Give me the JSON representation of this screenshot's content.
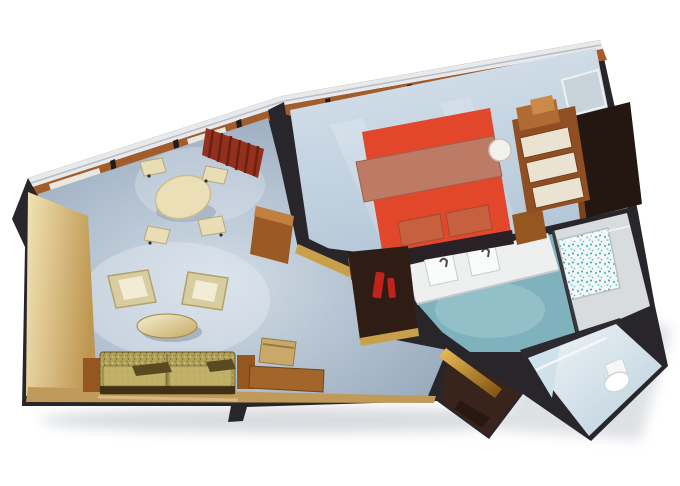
{
  "meta": {
    "title": "3D cutaway floor plan rendering of a suite",
    "view": "aerial dollhouse perspective, rotated, white background"
  },
  "palette": {
    "background": "#ffffff",
    "wall_dark": "#29262b",
    "rail_white": "#e7e9eb",
    "window_wood": "#a35d2a",
    "living_floor": "#a6b5c7",
    "bedroom_floor": "#c6d5e3",
    "bath_floor_teal": "#7fb2bd",
    "tub_room_gray": "#d8dcdf",
    "entrance_brown": "#38241b",
    "left_panel_cream": "#e7d5a2",
    "bottom_wood": "#c09a5a",
    "curtain_red": "#93301e",
    "curtain_red_dark": "#6b2012",
    "bed_red": "#e2462b",
    "blanket_rose": "#bd7a64",
    "pillow_rust": "#c7603f",
    "headboard_dark": "#2a2127",
    "sofa_gold": "#b2a158",
    "cushion_cream": "#f2ecd6",
    "chair_cream": "#e8ddb5",
    "table_cream": "#ebdfb8",
    "wood_furniture": "#a4652a",
    "cabinet_dark": "#2f1d15",
    "dresser_wood": "#8f4f22",
    "drawer_cream": "#eae3d1",
    "closet_dark": "#241711",
    "mirror_blue": "#c9d4da",
    "vanity_white": "#eef0f0",
    "minibar_red": "#c0231d",
    "gold_trim": "#c9a04a"
  },
  "rooms": {
    "living_room": {
      "label": "Living room",
      "furniture": [
        "round dining table",
        "four dining chairs",
        "red window curtain",
        "two cream armchairs",
        "oval coffee table",
        "gold fabric sofa",
        "two wood side tables",
        "writing desk",
        "desk chair",
        "tv cabinet on divider wall"
      ]
    },
    "bedroom": {
      "label": "Bedroom",
      "furniture": [
        "red double bed",
        "two pillows",
        "dark headboard",
        "wood nightstand",
        "dresser with cream drawers",
        "white stool",
        "wall mirror",
        "dark walk-in closet",
        "dark vanity cabinet with red bottles"
      ]
    },
    "bathroom": {
      "label": "Bathroom",
      "furniture": [
        "white double-sink vanity",
        "two faucets",
        "bathtub with patterned glass"
      ]
    },
    "toilet_room": {
      "label": "Toilet room",
      "furniture": [
        "toilet",
        "glass partition"
      ]
    },
    "entrance": {
      "label": "Entrance hallway",
      "furniture": [
        "gold corridor wall"
      ]
    }
  }
}
